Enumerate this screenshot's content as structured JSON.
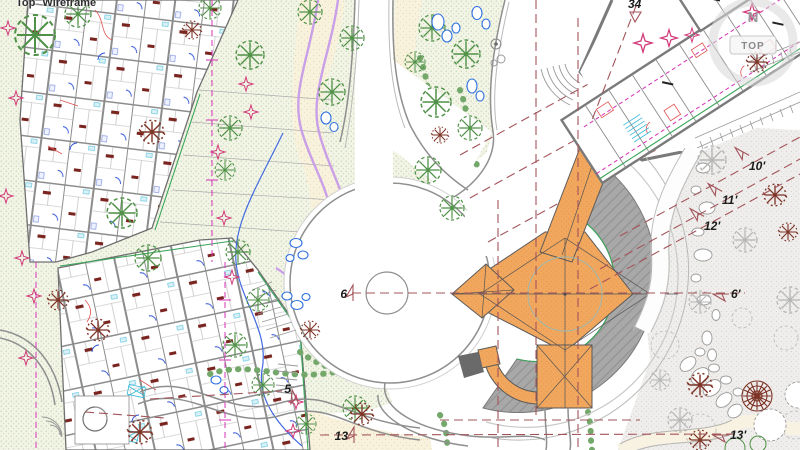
{
  "app": {
    "viewport_label_view": "Top",
    "viewport_label_style": "Wireframe"
  },
  "viewcube": {
    "north_letter": "N",
    "face_label": "TOP"
  },
  "annotations": {
    "m34": "34",
    "m6": "6",
    "m5": "5",
    "m13": "13",
    "m10r": "10'",
    "m11r": "11'",
    "m12r": "12'",
    "m6r": "6'",
    "m13r": "13'"
  },
  "colors": {
    "building_fill_orange": "#f2a75e",
    "building_dot_orange": "#dd8f44",
    "crescent_gray": "#a5a5a5",
    "plaza_gray_dots": "#efeeec",
    "lawn_green_dots": "#f2f5e6",
    "path_tan": "#f8f1dc",
    "section_line_red": "#a2545a",
    "property_line_magenta": "#d633b5",
    "plant_star_magenta": "#d23a7a",
    "path_edge_lavender": "#c9a0e8",
    "tree_green": "#4f9147",
    "tree_brown": "#7d3326",
    "rock_blue": "#2d6fe0",
    "wall_gray": "#6f6f6f",
    "furniture_red": "#e05050",
    "stair_cyan": "#38b8d8",
    "room_label_dark_red": "#7a241f"
  }
}
